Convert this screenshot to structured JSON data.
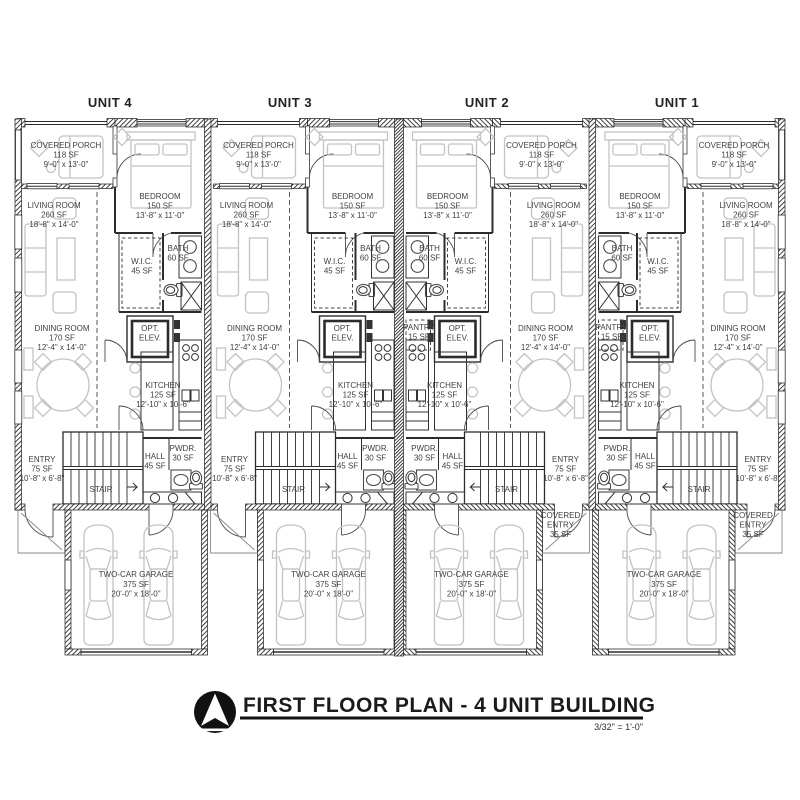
{
  "document": {
    "type": "architectural-floor-plan",
    "sheet_background": "#ffffff"
  },
  "title_block": {
    "title": "FIRST FLOOR PLAN - 4 UNIT BUILDING",
    "scale": "3/32\" = 1'-0\"",
    "north_arrow_icon": "north-arrow-icon"
  },
  "units": [
    {
      "label": "UNIT 4"
    },
    {
      "label": "UNIT 3"
    },
    {
      "label": "UNIT 2"
    },
    {
      "label": "UNIT 1"
    }
  ],
  "rooms": {
    "covered_porch": {
      "name": "COVERED PORCH",
      "area": "118 SF",
      "dims": "9'-0\" x 13'-0\""
    },
    "bedroom": {
      "name": "BEDROOM",
      "area": "150 SF",
      "dims": "13'-8\" x 11'-0\""
    },
    "living_room": {
      "name": "LIVING ROOM",
      "area": "260 SF",
      "dims": "18'-8\" x 14'-0\""
    },
    "wic": {
      "name": "W.I.C.",
      "area": "45 SF"
    },
    "bath": {
      "name": "BATH",
      "area": "60 SF"
    },
    "dining_room": {
      "name": "DINING ROOM",
      "area": "170 SF",
      "dims": "12'-4\" x 14'-0\""
    },
    "opt_elev": {
      "name": "OPT.",
      "name2": "ELEV."
    },
    "kitchen": {
      "name": "KITCHEN",
      "area": "125 SF",
      "dims": "12'-10\" x 10'-6\""
    },
    "pantry": {
      "name": "PANTRY",
      "area": "15 SF"
    },
    "entry": {
      "name": "ENTRY",
      "area": "75 SF",
      "dims": "10'-8\" x 6'-8\""
    },
    "stair": {
      "name": "STAIR"
    },
    "hall": {
      "name": "HALL",
      "area": "45 SF"
    },
    "powder": {
      "name": "PWDR.",
      "area": "30 SF"
    },
    "garage": {
      "name": "TWO-CAR GARAGE",
      "area": "375 SF",
      "dims": "20'-0\" x 18'-0\""
    },
    "covered_entry": {
      "name": "COVERED",
      "name2": "ENTRY",
      "area": "35 SF"
    }
  },
  "colors": {
    "wall": "#1f1f1f",
    "furniture": "#c3c3c3",
    "label_text": "#3f3f3f",
    "paper": "#ffffff"
  }
}
